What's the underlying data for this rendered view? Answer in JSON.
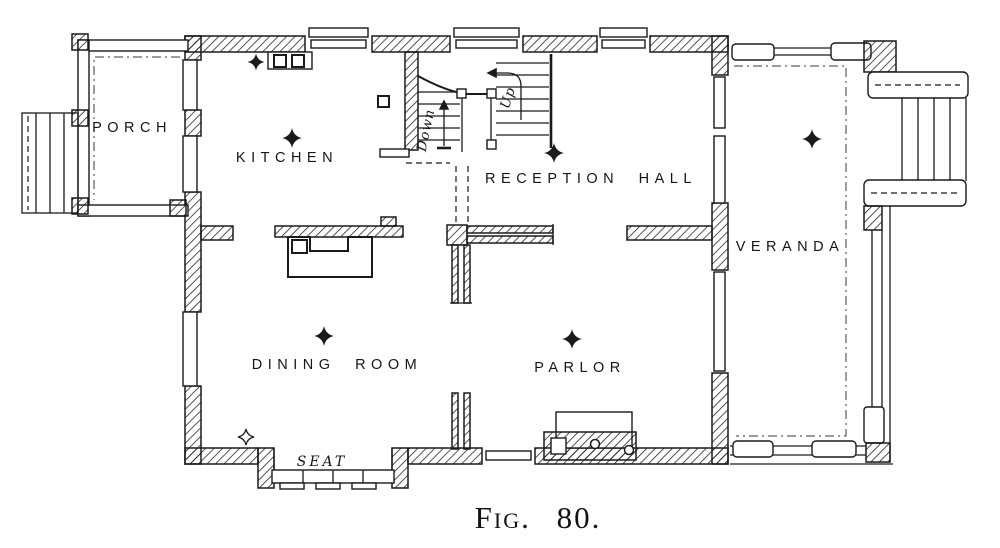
{
  "figure": {
    "caption": "Fig. 80."
  },
  "rooms": {
    "porch": {
      "label": "PORCH"
    },
    "kitchen": {
      "label": "KITCHEN"
    },
    "reception_hall": {
      "label": "RECEPTION HALL"
    },
    "veranda": {
      "label": "VERANDA"
    },
    "dining_room": {
      "label": "DINING ROOM"
    },
    "parlor": {
      "label": "PARLOR"
    }
  },
  "features": {
    "window_seat_label": "SEAT",
    "stair_up_label": "Up",
    "stair_down_label": "Down"
  },
  "symbols": {
    "ceiling_light_filled_count": 6,
    "ceiling_light_outline_count": 1
  },
  "colors": {
    "ink": "#1a1a1a",
    "paper": "#ffffff"
  }
}
